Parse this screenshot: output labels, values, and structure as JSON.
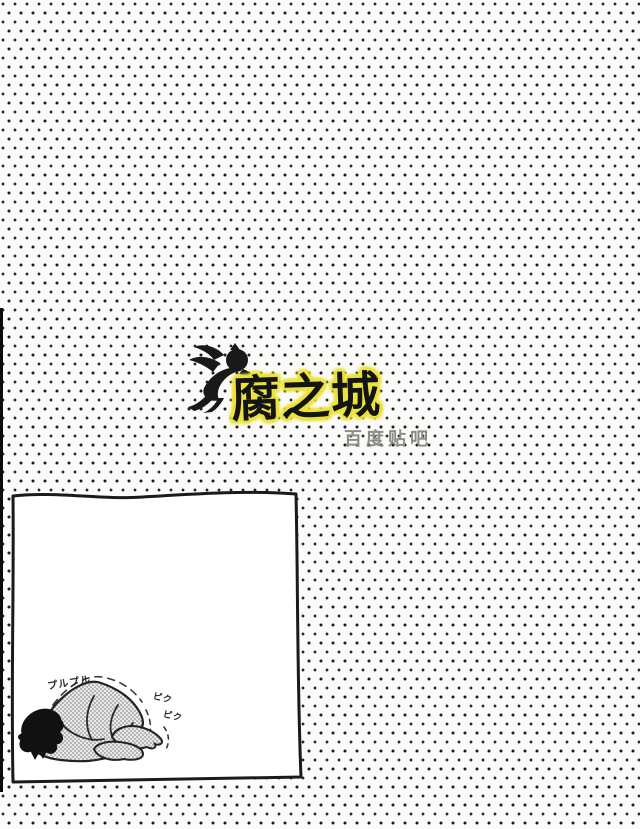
{
  "page": {
    "background_color": "#fbfbf9",
    "dot_color": "#1c1c1c",
    "description": "scanned doujinshi credit page with polka-dot background"
  },
  "logo": {
    "title": "腐之城",
    "subtitle": "百度贴吧",
    "highlight_color": "#ece23e",
    "text_color": "#141414",
    "subtitle_color": "#8d8d85",
    "cherub_icon": "flying-cherub-silhouette"
  },
  "panel": {
    "figure": "person curled face-down trembling",
    "sfx_tremble": "プルプル",
    "sfx_twitch_line1": "ピク",
    "sfx_twitch_line2": "ピク",
    "border_color": "#1a1a1a",
    "background_color": "#ffffff"
  }
}
